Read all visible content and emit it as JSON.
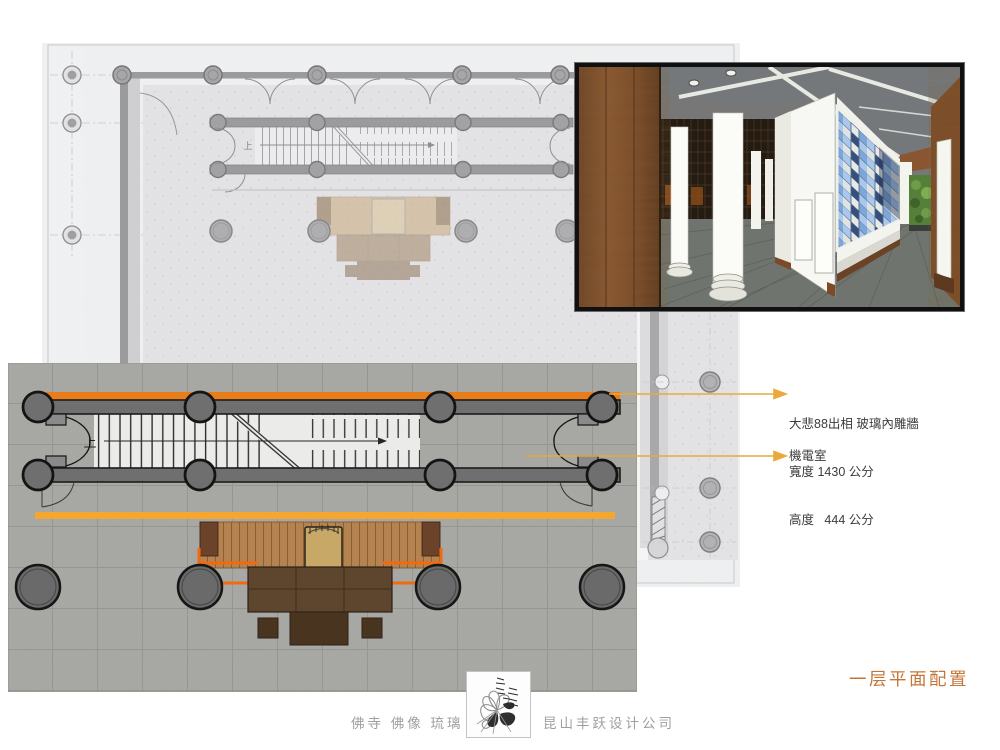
{
  "caption": {
    "text": "一层平面配置",
    "color": "#C4763A"
  },
  "annotations": {
    "wall_note": {
      "line1": "大悲88出相 玻璃內雕牆",
      "line2": "寬度 1430 公分",
      "line3": "高度   444 公分"
    },
    "room_note": "機電室"
  },
  "upper_plan": {
    "up_label": "上"
  },
  "lower_plan": {
    "up_label": "上"
  },
  "footer": {
    "tagline": "佛寺 佛像 琉璃",
    "company": "昆山丰跃设计公司"
  },
  "colors": {
    "beam_dark_orange": "#E87D1A",
    "beam_amber": "#F5A630",
    "platform_orange": "#F16A10",
    "leader_line": "#EAA93C",
    "caption_orange": "#C4763A",
    "glass_blue": "#7EA6D6"
  },
  "icons": [
    "up-direction-arrow",
    "stair-break-line",
    "leader-arrow",
    "lotus-logo"
  ]
}
